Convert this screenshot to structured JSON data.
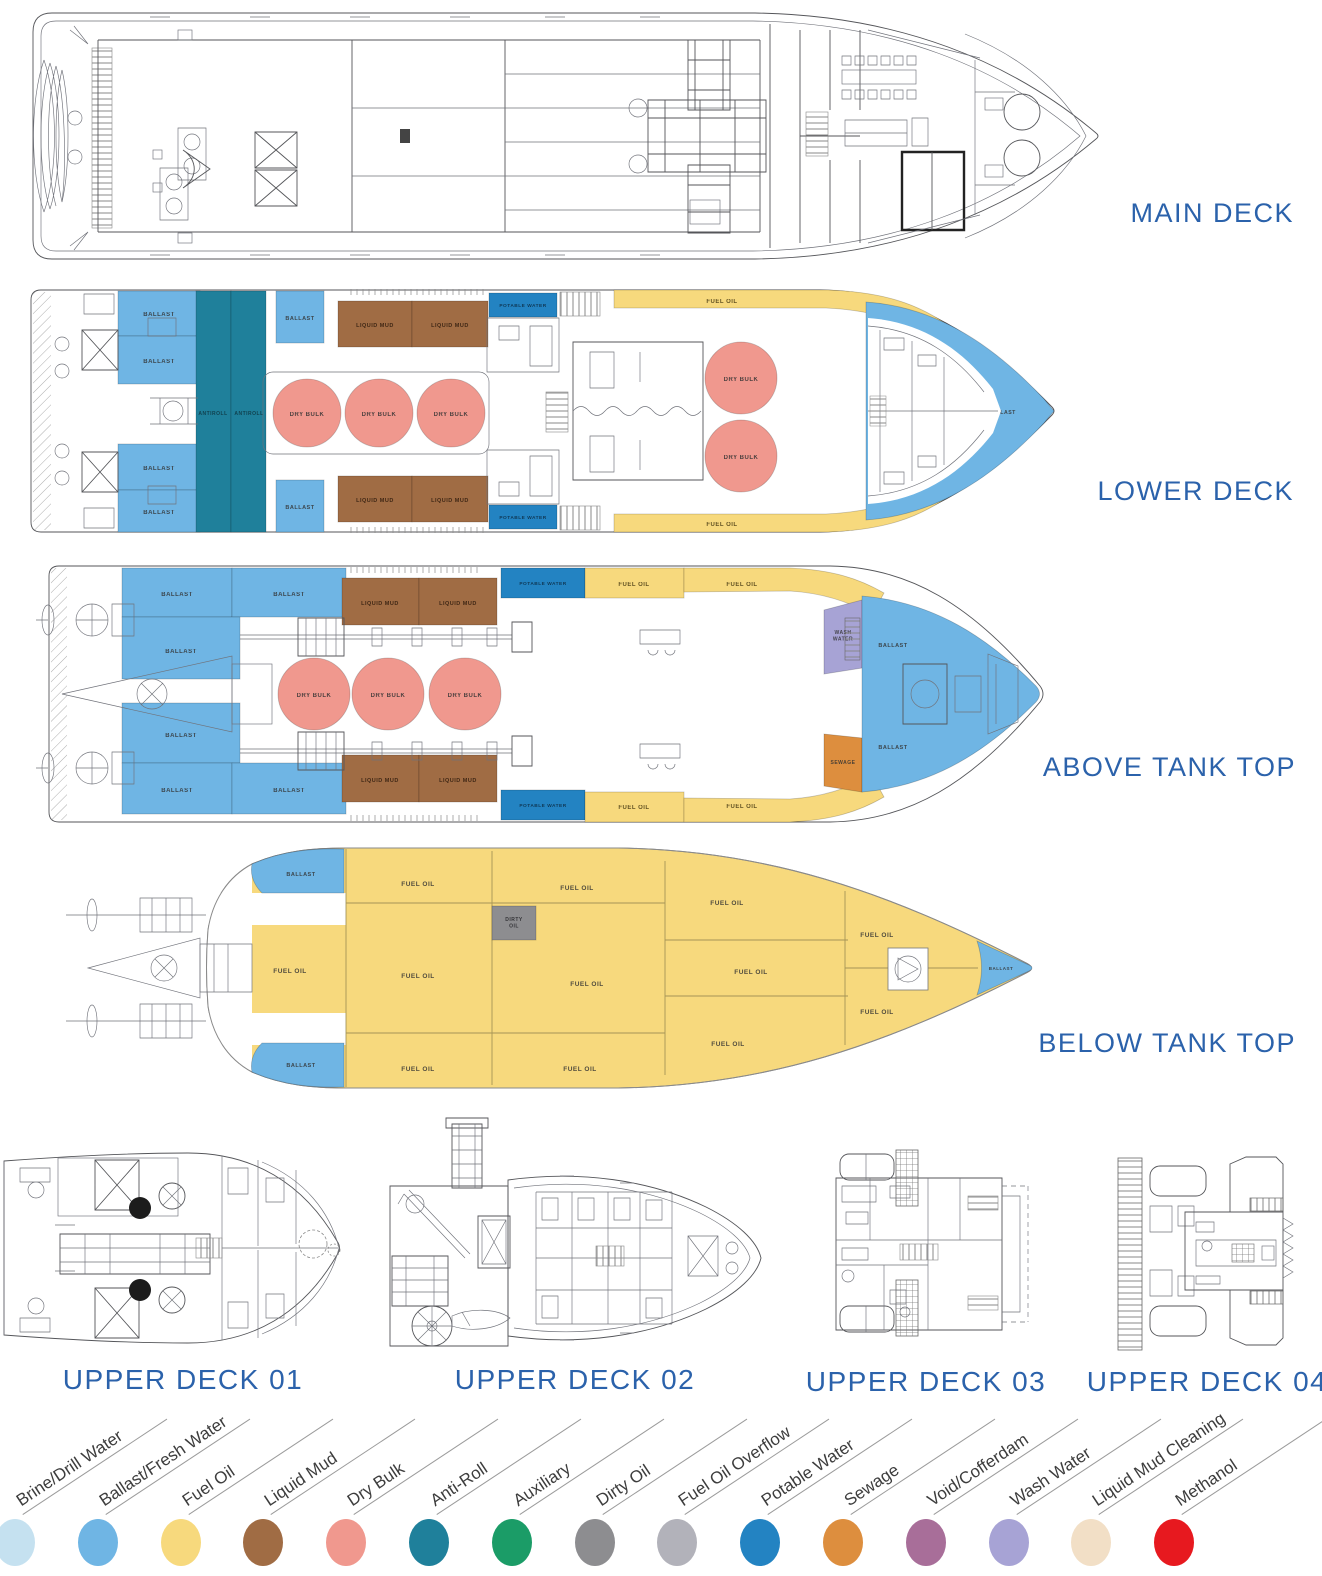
{
  "palette": {
    "brine_drill_water": "#C5E1F0",
    "ballast_fresh_water": "#6FB5E4",
    "fuel_oil": "#F7D97D",
    "liquid_mud": "#A06C44",
    "dry_bulk": "#F0988E",
    "anti_roll": "#1F809B",
    "auxiliary": "#1B9C67",
    "dirty_oil": "#8D8D90",
    "fuel_oil_overflow": "#B2B2BA",
    "potable_water": "#2383C2",
    "sewage": "#DD8E3E",
    "void_cofferdam": "#A86E99",
    "wash_water": "#A7A3D5",
    "liquid_mud_cleaning": "#F2DFC6",
    "methanol": "#E7191F",
    "heading": "#2B62AB",
    "tank_label": "#333333"
  },
  "titles": {
    "main": "MAIN DECK",
    "lower": "LOWER DECK",
    "above": "ABOVE TANK TOP",
    "below": "BELOW TANK TOP",
    "upper1": "UPPER DECK 01",
    "upper2": "UPPER DECK 02",
    "upper3": "UPPER DECK 03",
    "upper4": "UPPER DECK 04"
  },
  "legend": {
    "start_x": 15,
    "step": 82.8,
    "circle_top": 1519,
    "label_top": 1490,
    "items": [
      {
        "label": "Brine/Drill Water",
        "key": "brine_drill_water"
      },
      {
        "label": "Ballast/Fresh Water",
        "key": "ballast_fresh_water"
      },
      {
        "label": "Fuel Oil",
        "key": "fuel_oil"
      },
      {
        "label": "Liquid Mud",
        "key": "liquid_mud"
      },
      {
        "label": "Dry Bulk",
        "key": "dry_bulk"
      },
      {
        "label": "Anti-Roll",
        "key": "anti_roll"
      },
      {
        "label": "Auxiliary",
        "key": "auxiliary"
      },
      {
        "label": "Dirty Oil",
        "key": "dirty_oil"
      },
      {
        "label": "Fuel Oil Overflow",
        "key": "fuel_oil_overflow"
      },
      {
        "label": "Potable Water",
        "key": "potable_water"
      },
      {
        "label": "Sewage",
        "key": "sewage"
      },
      {
        "label": "Void/Cofferdam",
        "key": "void_cofferdam"
      },
      {
        "label": "Wash Water",
        "key": "wash_water"
      },
      {
        "label": "Liquid Mud Cleaning",
        "key": "liquid_mud_cleaning"
      },
      {
        "label": "Methanol",
        "key": "methanol"
      }
    ]
  },
  "tank_sets": {
    "lower": [
      {
        "s": "r",
        "x": 118,
        "y": 291,
        "w": 82,
        "h": 45,
        "f": "ballast_fresh_water",
        "t": "BALLAST",
        "lx": 159,
        "ly": 316,
        "fs": 6
      },
      {
        "s": "r",
        "x": 118,
        "y": 336,
        "w": 82,
        "h": 48,
        "f": "ballast_fresh_water",
        "t": "BALLAST",
        "lx": 159,
        "ly": 363,
        "fs": 6
      },
      {
        "s": "r",
        "x": 118,
        "y": 444,
        "w": 82,
        "h": 46,
        "f": "ballast_fresh_water",
        "t": "BALLAST",
        "lx": 159,
        "ly": 470,
        "fs": 6
      },
      {
        "s": "r",
        "x": 118,
        "y": 490,
        "w": 82,
        "h": 42,
        "f": "ballast_fresh_water",
        "t": "BALLAST",
        "lx": 159,
        "ly": 514,
        "fs": 6
      },
      {
        "s": "r",
        "x": 196,
        "y": 291,
        "w": 35,
        "h": 241,
        "f": "anti_roll",
        "t": "ANTIROLL",
        "lx": 213,
        "ly": 415,
        "fs": 5,
        "tc": "#0e3540"
      },
      {
        "s": "r",
        "x": 231,
        "y": 291,
        "w": 35,
        "h": 241,
        "f": "anti_roll",
        "t": "ANTIROLL",
        "lx": 249,
        "ly": 415,
        "fs": 5,
        "tc": "#0e3540"
      },
      {
        "s": "r",
        "x": 276,
        "y": 291,
        "w": 48,
        "h": 52,
        "f": "ballast_fresh_water",
        "t": "BALLAST",
        "lx": 300,
        "ly": 320,
        "fs": 5.5
      },
      {
        "s": "r",
        "x": 276,
        "y": 480,
        "w": 48,
        "h": 52,
        "f": "ballast_fresh_water",
        "t": "BALLAST",
        "lx": 300,
        "ly": 509,
        "fs": 5.5
      },
      {
        "s": "r",
        "x": 338,
        "y": 301,
        "w": 74,
        "h": 46,
        "f": "liquid_mud",
        "t": "LIQUID MUD",
        "lx": 375,
        "ly": 327,
        "fs": 5.5,
        "tc": "#2e1a0c"
      },
      {
        "s": "r",
        "x": 412,
        "y": 301,
        "w": 76,
        "h": 46,
        "f": "liquid_mud",
        "t": "LIQUID MUD",
        "lx": 450,
        "ly": 327,
        "fs": 5.5,
        "tc": "#2e1a0c"
      },
      {
        "s": "r",
        "x": 338,
        "y": 476,
        "w": 74,
        "h": 46,
        "f": "liquid_mud",
        "t": "LIQUID MUD",
        "lx": 375,
        "ly": 502,
        "fs": 5.5,
        "tc": "#2e1a0c"
      },
      {
        "s": "r",
        "x": 412,
        "y": 476,
        "w": 76,
        "h": 46,
        "f": "liquid_mud",
        "t": "LIQUID MUD",
        "lx": 450,
        "ly": 502,
        "fs": 5.5,
        "tc": "#2e1a0c"
      },
      {
        "s": "c",
        "cx": 307,
        "cy": 413,
        "r": 34,
        "f": "dry_bulk",
        "t": "DRY BULK",
        "lx": 307,
        "ly": 416,
        "fs": 6
      },
      {
        "s": "c",
        "cx": 379,
        "cy": 413,
        "r": 34,
        "f": "dry_bulk",
        "t": "DRY BULK",
        "lx": 379,
        "ly": 416,
        "fs": 6
      },
      {
        "s": "c",
        "cx": 451,
        "cy": 413,
        "r": 34,
        "f": "dry_bulk",
        "t": "DRY BULK",
        "lx": 451,
        "ly": 416,
        "fs": 6
      },
      {
        "s": "r",
        "x": 489,
        "y": 293,
        "w": 68,
        "h": 24,
        "f": "potable_water",
        "t": "POTABLE WATER",
        "lx": 523,
        "ly": 307,
        "fs": 4.8,
        "tc": "#0c2c44"
      },
      {
        "s": "r",
        "x": 489,
        "y": 505,
        "w": 68,
        "h": 24,
        "f": "potable_water",
        "t": "POTABLE WATER",
        "lx": 523,
        "ly": 519,
        "fs": 4.8,
        "tc": "#0c2c44"
      },
      {
        "s": "p",
        "d": "M614,290 L828,290 C882,292 918,303 952,328 L941,343 C906,320 870,310 826,308 L614,308 Z",
        "f": "fuel_oil",
        "t": "FUEL OIL",
        "lx": 722,
        "ly": 303,
        "fs": 6,
        "tc": "#4a3c14"
      },
      {
        "s": "p",
        "d": "M614,532 L828,532 C882,530 918,519 952,494 L941,479 C906,502 870,512 826,514 L614,514 Z",
        "f": "fuel_oil",
        "t": "FUEL OIL",
        "lx": 722,
        "ly": 526,
        "fs": 6,
        "tc": "#4a3c14"
      },
      {
        "s": "c",
        "cx": 741,
        "cy": 378,
        "r": 36,
        "f": "dry_bulk",
        "t": "DRY BULK",
        "lx": 741,
        "ly": 381,
        "fs": 6
      },
      {
        "s": "c",
        "cx": 741,
        "cy": 456,
        "r": 36,
        "f": "dry_bulk",
        "t": "DRY BULK",
        "lx": 741,
        "ly": 459,
        "fs": 6
      },
      {
        "s": "p",
        "d": "M866,302 C938,307 994,346 1044,399 L1054,411 L1044,423 C994,476 938,515 866,520 Z",
        "f": "ballast_fresh_water"
      },
      {
        "s": "l",
        "t": "BALLAST",
        "lx": 917,
        "ly": 356,
        "fs": 5.2
      },
      {
        "s": "l",
        "t": "BALLAST",
        "lx": 917,
        "ly": 473,
        "fs": 5.2
      },
      {
        "s": "l",
        "t": "BALLAST",
        "lx": 1002,
        "ly": 414,
        "fs": 5.2
      }
    ],
    "above": [
      {
        "s": "r",
        "x": 122,
        "y": 568,
        "w": 110,
        "h": 49,
        "f": "ballast_fresh_water",
        "t": "BALLAST",
        "lx": 177,
        "ly": 596,
        "fs": 6
      },
      {
        "s": "r",
        "x": 232,
        "y": 568,
        "w": 114,
        "h": 49,
        "f": "ballast_fresh_water",
        "t": "BALLAST",
        "lx": 289,
        "ly": 596,
        "fs": 6
      },
      {
        "s": "r",
        "x": 122,
        "y": 617,
        "w": 118,
        "h": 62,
        "f": "ballast_fresh_water",
        "t": "BALLAST",
        "lx": 181,
        "ly": 653,
        "fs": 6
      },
      {
        "s": "r",
        "x": 122,
        "y": 703,
        "w": 118,
        "h": 60,
        "f": "ballast_fresh_water",
        "t": "BALLAST",
        "lx": 181,
        "ly": 737,
        "fs": 6
      },
      {
        "s": "r",
        "x": 122,
        "y": 763,
        "w": 110,
        "h": 51,
        "f": "ballast_fresh_water",
        "t": "BALLAST",
        "lx": 177,
        "ly": 792,
        "fs": 6
      },
      {
        "s": "r",
        "x": 232,
        "y": 763,
        "w": 114,
        "h": 51,
        "f": "ballast_fresh_water",
        "t": "BALLAST",
        "lx": 289,
        "ly": 792,
        "fs": 6
      },
      {
        "s": "r",
        "x": 342,
        "y": 578,
        "w": 77,
        "h": 47,
        "f": "liquid_mud",
        "t": "LIQUID MUD",
        "lx": 380,
        "ly": 605,
        "fs": 5.5,
        "tc": "#2e1a0c"
      },
      {
        "s": "r",
        "x": 419,
        "y": 578,
        "w": 78,
        "h": 47,
        "f": "liquid_mud",
        "t": "LIQUID MUD",
        "lx": 458,
        "ly": 605,
        "fs": 5.5,
        "tc": "#2e1a0c"
      },
      {
        "s": "r",
        "x": 342,
        "y": 755,
        "w": 77,
        "h": 47,
        "f": "liquid_mud",
        "t": "LIQUID MUD",
        "lx": 380,
        "ly": 782,
        "fs": 5.5,
        "tc": "#2e1a0c"
      },
      {
        "s": "r",
        "x": 419,
        "y": 755,
        "w": 78,
        "h": 47,
        "f": "liquid_mud",
        "t": "LIQUID MUD",
        "lx": 458,
        "ly": 782,
        "fs": 5.5,
        "tc": "#2e1a0c"
      },
      {
        "s": "c",
        "cx": 314,
        "cy": 694,
        "r": 36,
        "f": "dry_bulk",
        "t": "DRY BULK",
        "lx": 314,
        "ly": 697,
        "fs": 6
      },
      {
        "s": "c",
        "cx": 388,
        "cy": 694,
        "r": 36,
        "f": "dry_bulk",
        "t": "DRY BULK",
        "lx": 388,
        "ly": 697,
        "fs": 6
      },
      {
        "s": "c",
        "cx": 465,
        "cy": 694,
        "r": 36,
        "f": "dry_bulk",
        "t": "DRY BULK",
        "lx": 465,
        "ly": 697,
        "fs": 6
      },
      {
        "s": "r",
        "x": 501,
        "y": 568,
        "w": 84,
        "h": 30,
        "f": "potable_water",
        "t": "POTABLE WATER",
        "lx": 543,
        "ly": 585,
        "fs": 4.8,
        "tc": "#0c2c44"
      },
      {
        "s": "r",
        "x": 501,
        "y": 790,
        "w": 84,
        "h": 30,
        "f": "potable_water",
        "t": "POTABLE WATER",
        "lx": 543,
        "ly": 807,
        "fs": 4.8,
        "tc": "#0c2c44"
      },
      {
        "s": "r",
        "x": 585,
        "y": 568,
        "w": 99,
        "h": 30,
        "f": "fuel_oil",
        "t": "FUEL OIL",
        "lx": 634,
        "ly": 586,
        "fs": 6,
        "tc": "#4a3c14"
      },
      {
        "s": "p",
        "d": "M684,568 L790,568 C832,570 858,578 884,593 L872,615 C848,601 822,593 790,591 L684,592 Z",
        "f": "fuel_oil",
        "t": "FUEL OIL",
        "lx": 742,
        "ly": 586,
        "fs": 6,
        "tc": "#4a3c14"
      },
      {
        "s": "r",
        "x": 585,
        "y": 792,
        "w": 99,
        "h": 30,
        "f": "fuel_oil",
        "t": "FUEL OIL",
        "lx": 634,
        "ly": 809,
        "fs": 6,
        "tc": "#4a3c14"
      },
      {
        "s": "p",
        "d": "M684,822 L790,822 C832,820 858,812 884,797 L872,775 C848,789 822,797 790,799 L684,798 Z",
        "f": "fuel_oil",
        "t": "FUEL OIL",
        "lx": 742,
        "ly": 808,
        "fs": 6,
        "tc": "#4a3c14"
      },
      {
        "s": "p",
        "d": "M824,610 L862,600 L862,668 L824,674 Z",
        "f": "wash_water",
        "t": "WASH|WATER",
        "lx": 843,
        "ly": 634,
        "fs": 5
      },
      {
        "s": "p",
        "d": "M824,734 L862,738 L862,792 L824,786 Z",
        "f": "sewage",
        "t": "SEWAGE",
        "lx": 843,
        "ly": 764,
        "fs": 5
      },
      {
        "s": "p",
        "d": "M862,596 C935,602 988,638 1036,686 Q1043,694 1036,702 C988,750 935,786 862,792 Z",
        "f": "ballast_fresh_water"
      },
      {
        "s": "l",
        "t": "BALLAST",
        "lx": 893,
        "ly": 647,
        "fs": 5.5
      },
      {
        "s": "l",
        "t": "BALLAST",
        "lx": 893,
        "ly": 749,
        "fs": 5.5
      }
    ],
    "below": [
      {
        "s": "p",
        "d": "M252,864 C282,851 312,848 344,849 L344,893 L262,893 C253,884 250,874 252,864 Z",
        "f": "ballast_fresh_water",
        "t": "BALLAST",
        "lx": 301,
        "ly": 876,
        "fs": 5.5
      },
      {
        "s": "p",
        "d": "M252,1072 C282,1085 312,1088 344,1087 L344,1043 L262,1043 C253,1052 250,1062 252,1072 Z",
        "f": "ballast_fresh_water",
        "t": "BALLAST",
        "lx": 301,
        "ly": 1067,
        "fs": 5.5
      },
      {
        "s": "r",
        "x": 492,
        "y": 906,
        "w": 44,
        "h": 34,
        "f": "dirty_oil",
        "t": "DIRTY|OIL",
        "lx": 514,
        "ly": 921,
        "fs": 5,
        "tc": "#26262a"
      },
      {
        "s": "p",
        "d": "M977,941 C996,950 1014,958 1029,965 Q1035,968 1029,971 C1014,978 996,986 977,995 C983,977 983,959 977,941 Z",
        "f": "ballast_fresh_water",
        "t": "BALLAST",
        "lx": 1001,
        "ly": 970,
        "fs": 4.5
      },
      {
        "s": "l",
        "t": "FUEL OIL",
        "lx": 418,
        "ly": 886,
        "fs": 6.5
      },
      {
        "s": "l",
        "t": "FUEL OIL",
        "lx": 577,
        "ly": 890,
        "fs": 6.5
      },
      {
        "s": "l",
        "t": "FUEL OIL",
        "lx": 727,
        "ly": 905,
        "fs": 6.5
      },
      {
        "s": "l",
        "t": "FUEL OIL",
        "lx": 290,
        "ly": 973,
        "fs": 6.5
      },
      {
        "s": "l",
        "t": "FUEL OIL",
        "lx": 418,
        "ly": 978,
        "fs": 6.5
      },
      {
        "s": "l",
        "t": "FUEL OIL",
        "lx": 587,
        "ly": 986,
        "fs": 6.5
      },
      {
        "s": "l",
        "t": "FUEL OIL",
        "lx": 751,
        "ly": 974,
        "fs": 6.5
      },
      {
        "s": "l",
        "t": "FUEL OIL",
        "lx": 877,
        "ly": 937,
        "fs": 6.5
      },
      {
        "s": "l",
        "t": "FUEL OIL",
        "lx": 877,
        "ly": 1014,
        "fs": 6.5
      },
      {
        "s": "l",
        "t": "FUEL OIL",
        "lx": 418,
        "ly": 1071,
        "fs": 6.5
      },
      {
        "s": "l",
        "t": "FUEL OIL",
        "lx": 580,
        "ly": 1071,
        "fs": 6.5
      },
      {
        "s": "l",
        "t": "FUEL OIL",
        "lx": 728,
        "ly": 1046,
        "fs": 6.5
      }
    ]
  }
}
